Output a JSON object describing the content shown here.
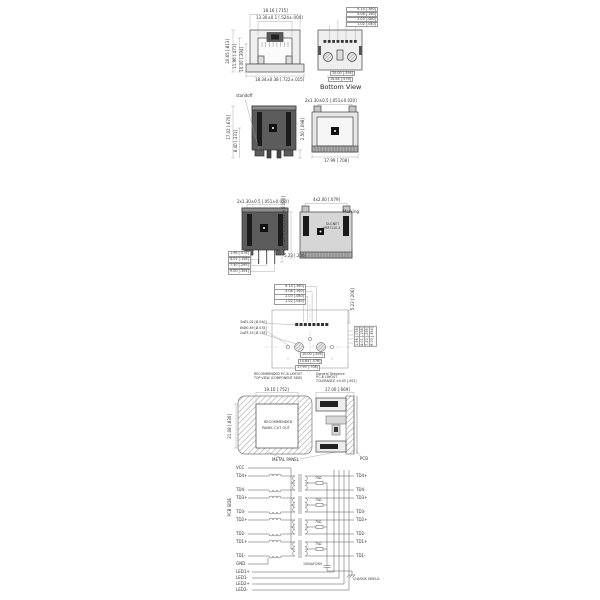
{
  "front_view": {
    "dim_top_width": "18.16 [.715]",
    "dim_top_opening": "13.30±0.1 [.524±.004]",
    "dim_left_total": "20.65 [.813]",
    "dim_left_body": "11.96 [.471]",
    "dim_left_opening": "10.00 [.394]",
    "dim_bottom_width": "18.34±0.38 [.722±.015]"
  },
  "bottom_view": {
    "caption": "Bottom View",
    "dims_stack": [
      "9.14 [.360]",
      "4.06 [.160]",
      "2.03 [.080]",
      "1.02 [.040]"
    ],
    "dim_bottom_inner": "10.00 [.394]",
    "dim_bottom_outer": "14.64 [.576]"
  },
  "side_view": {
    "standoff_label": "standoff",
    "dim_height": "17.02 [.670]",
    "dim_mid": "8.40 [.331]",
    "dim_standoff": "2.50 [.098]"
  },
  "rear_view": {
    "dim_top": "2x1.30±0.5 [.051±0.020]",
    "dim_width": "17.99 [.708]"
  },
  "side_view2": {
    "dim_top": "2x1.30±0.5 [.051±0.020]",
    "dims_stack": [
      "1.96 [.078]",
      "4.01 [.158]",
      "7.50 [.295]",
      "9.00 [.354]"
    ],
    "dim_right": "5.23 [.206]"
  },
  "marking_view": {
    "dim_top": "4x2.00 [.079]",
    "dim_left": "4x7.40±0.5 [.291±0.020]",
    "marking_label": "Marking",
    "marking_line1": "DLGNET",
    "marking_line2": "JHM7110-4"
  },
  "pcb_layout": {
    "dims_stack_top": [
      "9.14 [.360]",
      "4.06 [.160]",
      "2.03 [.080]",
      "1.02 [.040]"
    ],
    "dim_right_top": "5.23 [.206]",
    "dims_stack_right": [
      "1.96 [.078]",
      "4.01 [.158]",
      "7.50 [.295]",
      "9.00 [.354]"
    ],
    "callouts": [
      "3xØ1.02 [Ø.040]",
      "8xØ0.89 [Ø.035]",
      "2xØ3.25 [Ø.128]"
    ],
    "dims_bottom": [
      "10.00 [.394]",
      "14.64 [.576]",
      "17.99 [.708]"
    ],
    "note_left1": "RECOMMENDED P.C.B LAYOUT",
    "note_left2": "TOP VIEW (COMPONENT SIDE)",
    "note_right1": "General Tolerance",
    "note_right2": "P.C.B LAYOUT",
    "note_right3": "TOLERANCE ±0.05 [.002]"
  },
  "panel_cutout": {
    "dim_top_left": "19.10 [.752]",
    "dim_left": "21.08 [.830]",
    "cutout_line1": "RECOMMENDED",
    "cutout_line2": "PANEL CUT OUT",
    "metal_panel": "METAL PANEL",
    "dim_top_right": "17.00 [.669]",
    "pcb": "PCB"
  },
  "schematic": {
    "side_label": "PCB SIDE",
    "left_pins": [
      "VCC",
      "TD4+",
      "TD4-",
      "TD3+",
      "TD3-",
      "TD2+",
      "TD2-",
      "TD1+",
      "TD1-",
      "GND",
      "LED1+",
      "LED1-",
      "LED2+",
      "LED2-"
    ],
    "right_pins": [
      "TD4+",
      "TD4-",
      "TD3+",
      "TD3-",
      "TD2+",
      "TD2-",
      "TD1+",
      "TD1-"
    ],
    "resistor_note": "75Ω",
    "cap_note": "1000pF/2KV",
    "shield_label": "CHASSIS SHIELD"
  }
}
